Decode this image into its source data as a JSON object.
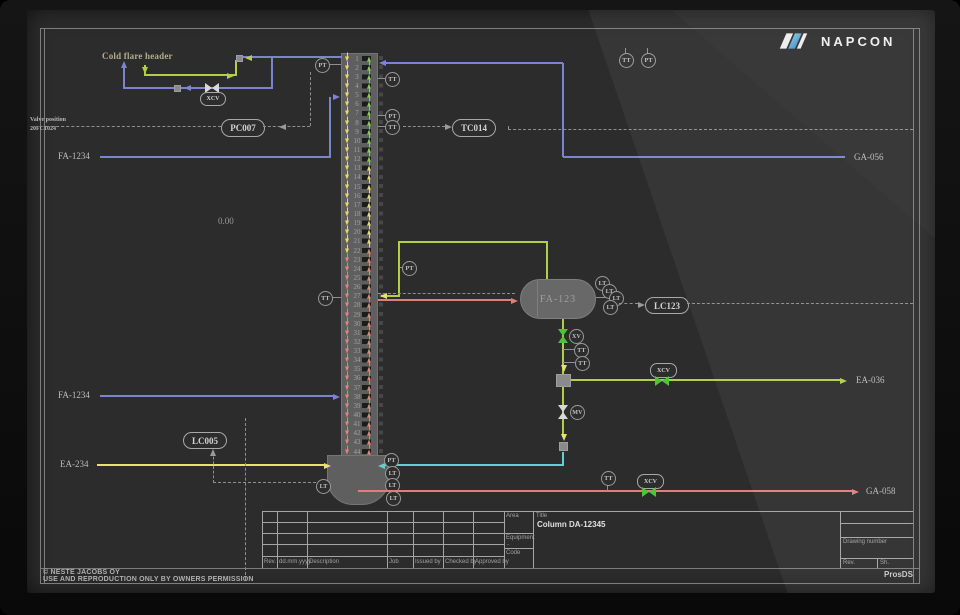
{
  "brand": {
    "name": "NAPCON"
  },
  "annotations": {
    "cold_flare_header": "Cold flare header",
    "valve_position": "Valve position",
    "valve_position_tag": "20FC1024",
    "zero_value": "0.00"
  },
  "controllers": {
    "pc007": "PC007",
    "tc014": "TC014",
    "lc123": "LC123",
    "lc005": "LC005"
  },
  "inst": {
    "tt": "TT",
    "pt": "PT",
    "lt": "LT",
    "xv": "XV",
    "mv": "MV",
    "xcv": "XCV"
  },
  "streams": {
    "fa1234_upper": "FA-1234",
    "fa1234_lower": "FA-1234",
    "ea234": "EA-234",
    "ga056": "GA-056",
    "ea036": "EA-036",
    "ga058": "GA-058"
  },
  "equipment": {
    "drum_label": "FA-123",
    "column_title": "Column DA-12345"
  },
  "column": {
    "tray_count": 44,
    "left_arrow_zones": [
      {
        "start": 1,
        "end": 22,
        "color": "#e3dc6c"
      },
      {
        "start": 23,
        "end": 44,
        "color": "#e0837d"
      }
    ],
    "right_arrow_zones": [
      {
        "start": 1,
        "end": 12,
        "color": "#8ecb49"
      },
      {
        "start": 13,
        "end": 21,
        "color": "#e3dc6c"
      },
      {
        "start": 22,
        "end": 44,
        "color": "#e0837d"
      }
    ]
  },
  "title_block": {
    "rev_headers": [
      "Rev.",
      "dd.mm.yyyy",
      "Description",
      "Job",
      "Issued by",
      "Checked by",
      "Approved by"
    ],
    "area_label": "Area",
    "equipment_label": "Equipment",
    "equipment_value": "-",
    "code_label": "Code",
    "title_label": "Title",
    "drawing_number_label": "Drawing number",
    "rev_label": "Rev.",
    "sheet_label": "Sh."
  },
  "footer": {
    "copyright_line1": "© NESTE JACOBS OY",
    "copyright_line2": "USE AND REPRODUCTION ONLY BY OWNERS PERMISSION",
    "system_name": "ProsDS"
  },
  "colors": {
    "blue": "#7b84cf",
    "green": "#b2cf4a",
    "yellow": "#e8e36e",
    "red": "#dd807c",
    "cyan": "#64cfcf",
    "dash": "#8f8f8f",
    "bright_green_valve": "#4fc43a"
  }
}
